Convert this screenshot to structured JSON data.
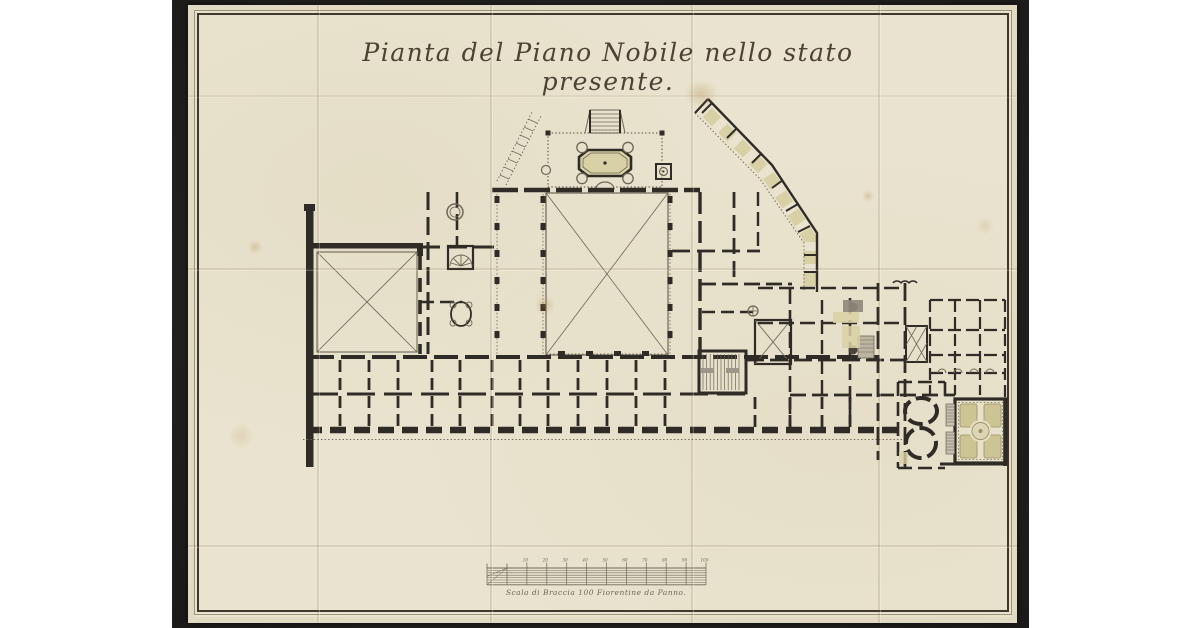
{
  "drawing": {
    "title": "Pianta del Piano Nobile nello stato presente.",
    "subject": "piano nobile floor plan, present state"
  },
  "scale_bar": {
    "caption": "Scala di Braccia 100 Fiorentine da Panno.",
    "ticks": [
      "10",
      "20",
      "30",
      "40",
      "50",
      "60",
      "70",
      "80",
      "90",
      "100"
    ]
  },
  "colors": {
    "page_bg": "#ffffff",
    "photo": "#242221",
    "paper": "#e9e3cf",
    "paper_edge": "#ddd5bc",
    "frame": "#3e382d",
    "frame_light": "#8a8068",
    "ink": "#2f2b26",
    "thin": "#6e6757",
    "tint": "#d8d1a6",
    "tint_strong": "#cdc493",
    "title_ink": "#4c4335"
  }
}
